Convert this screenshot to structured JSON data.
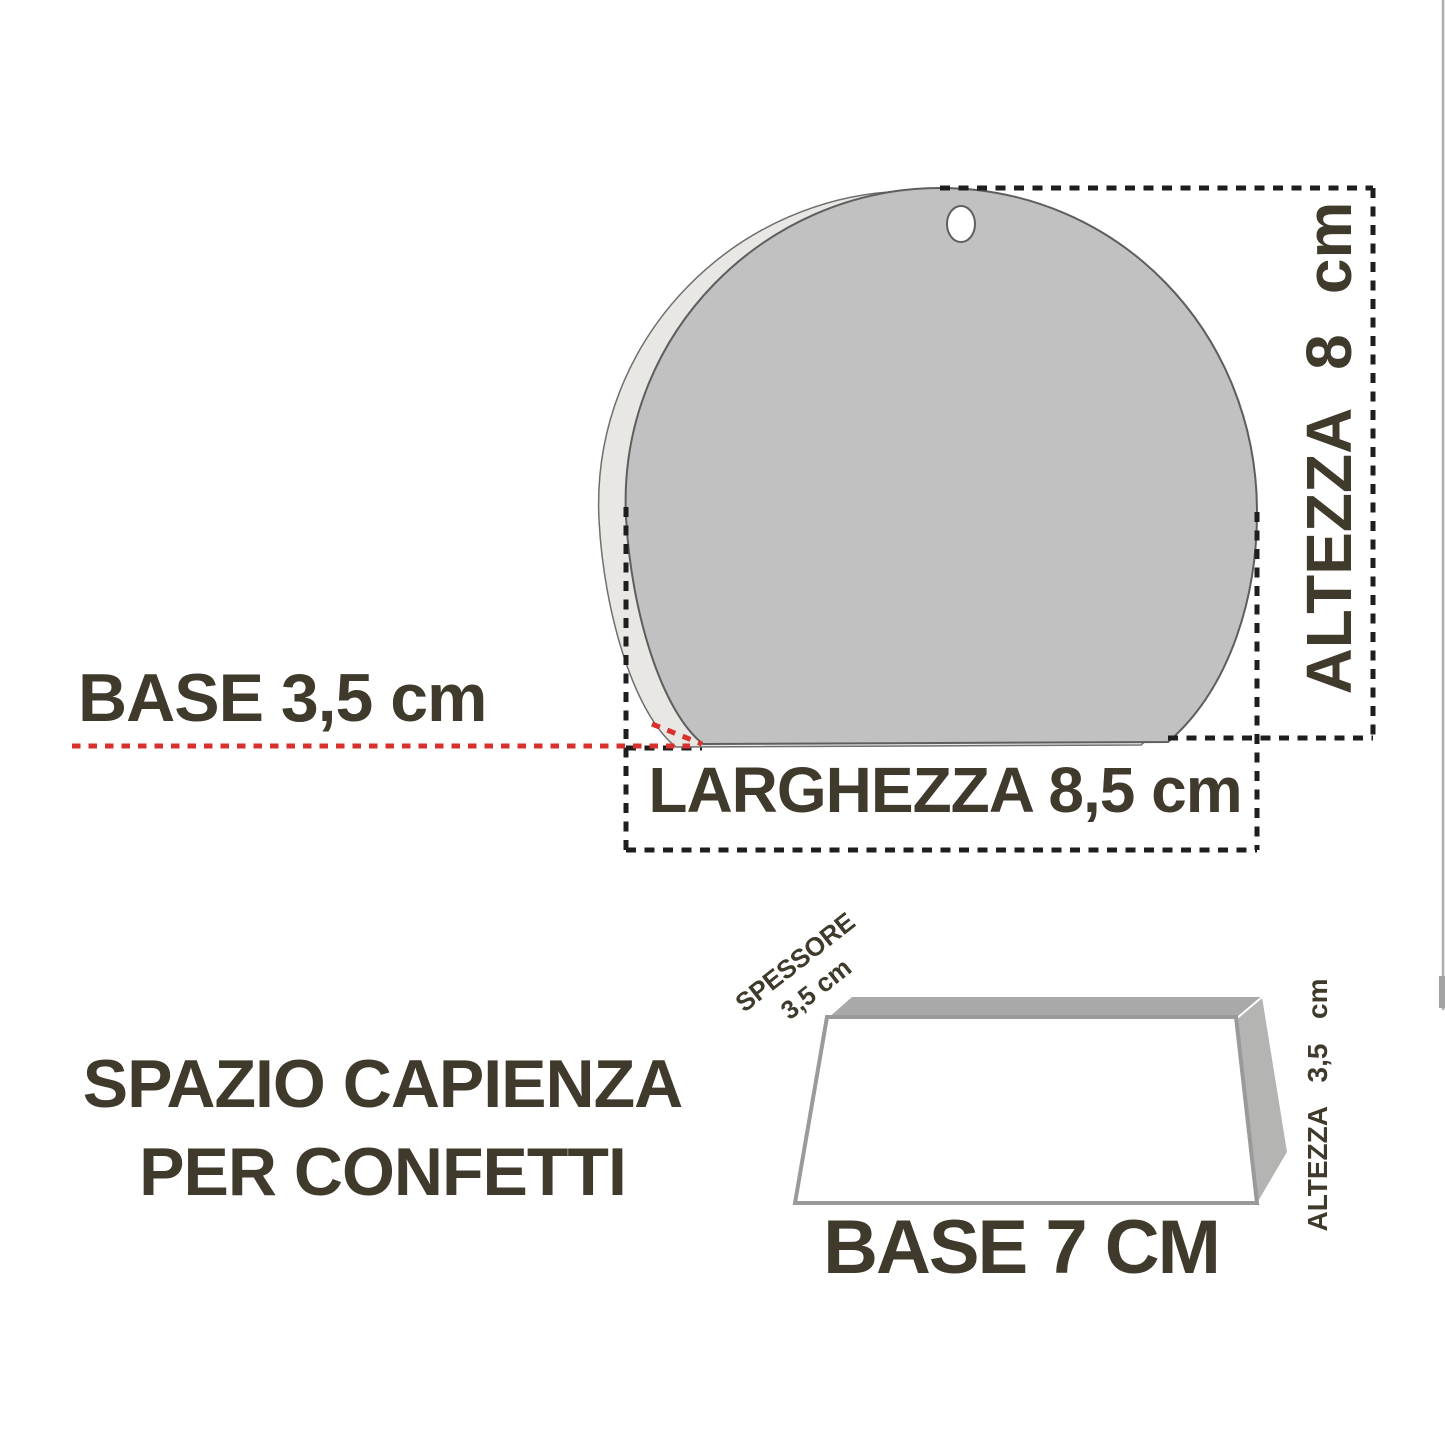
{
  "colors": {
    "ink": "#3f3a2b",
    "dimension_dash": "#1e1e1e",
    "accent_red": "#d8312d",
    "shape_front_gray": "#c1c1c1",
    "shape_depth_gray": "#e8e7e4",
    "tray_top_gray": "#a9a9a9",
    "tray_side_gray": "#b4b4b3"
  },
  "figure_top": {
    "height_label": "ALTEZZA 8 cm",
    "base_label": "BASE 3,5 cm",
    "width_label": "LARGHEZZA 8,5 cm"
  },
  "figure_bottom": {
    "caption_line1": "SPAZIO CAPIENZA",
    "caption_line2": "PER CONFETTI",
    "thickness_label_line1": "SPESSORE",
    "thickness_label_line2": "3,5 cm",
    "height_label": "ALTEZZA 3,5 cm",
    "base_label": "BASE 7 CM"
  }
}
